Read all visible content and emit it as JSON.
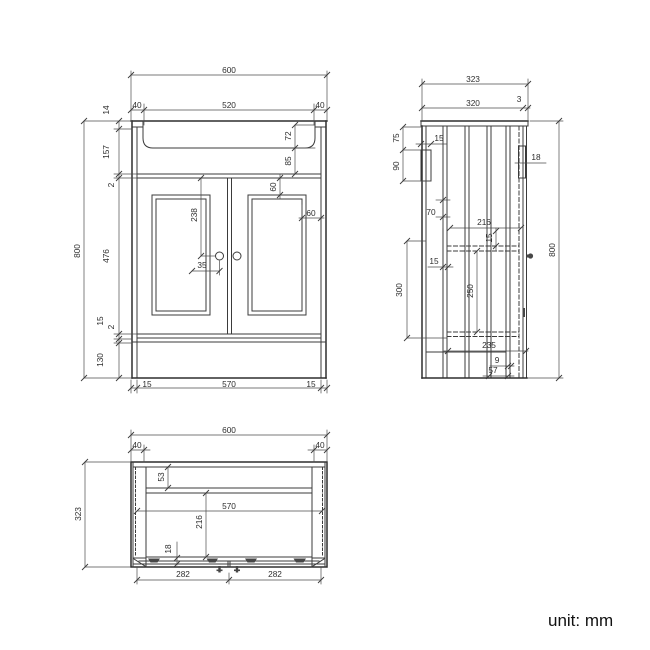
{
  "unit_note": "unit: mm",
  "front_view": {
    "overall_width": "600",
    "basin_width": "520",
    "left_margin": "40",
    "right_margin": "40",
    "rim_height": "14",
    "upper_section": "157",
    "top_gap": "2",
    "door_section": "476",
    "bottom_rail": "15",
    "bottom_gap": "2",
    "plinth_height": "130",
    "overall_height": "800",
    "basin_depth": "72",
    "apron_height": "85",
    "panel_top_inset": "60",
    "panel_side_inset": "60",
    "handle_drop": "238",
    "handle_offset": "35",
    "left_side_thickness": "15",
    "inner_width": "570",
    "right_side_thickness": "15"
  },
  "side_view": {
    "overall_depth": "323",
    "top_depth": "320",
    "front_edge": "3",
    "bracket_offset": "75",
    "bracket_height": "90",
    "bracket_width": "15",
    "top_rail": "18",
    "rail_drop": "70",
    "inner_depth": "216",
    "shelf_thickness": "15",
    "panel_thickness": "15",
    "opening_height": "300",
    "shelf_spacing": "250",
    "overall_height": "800",
    "base_depth": "235",
    "plinth_recess": "9",
    "plinth_depth": "57"
  },
  "plan_view": {
    "overall_width": "600",
    "left_margin": "40",
    "right_margin": "40",
    "back_rail": "53",
    "inner_width": "570",
    "inner_depth": "216",
    "door_thickness": "18",
    "left_door_width": "282",
    "right_door_width": "282",
    "overall_depth": "323"
  }
}
